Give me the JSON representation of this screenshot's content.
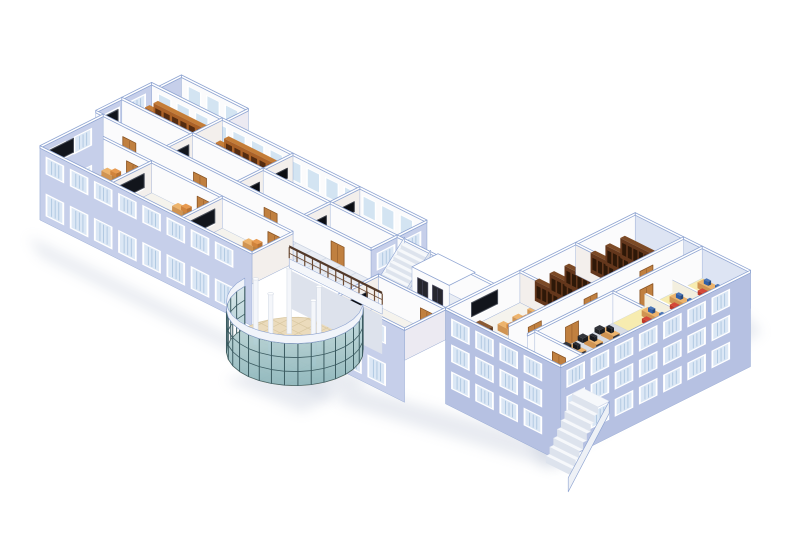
{
  "scene": {
    "canvas": {
      "w": 800,
      "h": 550,
      "background": "#ffffff"
    },
    "iso": {
      "ox": 40,
      "oy": 178,
      "kx": 1.86,
      "ky": 0.93,
      "wallH": 30
    },
    "palette": {
      "wallLavender": "#c6cfea",
      "wallLavenderDark": "#b6c1e2",
      "wallLavenderLight": "#dde4f3",
      "capFill": "#ffffff",
      "capLine": "#8da3d1",
      "interiorBright": "#fbfbfc",
      "interiorWarm": "#f3efec",
      "interiorShade": "#eceaf2",
      "floorRoom": "#f5f3ed",
      "floorCorr": "#e9edf4",
      "floorLab": "#d8dce4",
      "floorYellow": "#f0e9c4",
      "floorTerrace": "#eef1f7",
      "gridLine": "#ced6e3",
      "floorLobby": "#ebdbbc",
      "gridLobby": "#d9c8a2",
      "winFrame": "#ffffff",
      "winGlass": "#dbe7f5",
      "winStripe": "#adc6e0",
      "intWin": "#d3e4f2",
      "door": "#c08040",
      "doorDark": "#8a5424",
      "board": "#12151c",
      "boardFrame": "#4a4f5a",
      "tv": "#0b0d12",
      "deskTop": "#edb46d",
      "deskFront": "#d09452",
      "deskSide": "#ba8040",
      "chairTop": "#e79a50",
      "chairFront": "#d0833c",
      "chairSide": "#b87232",
      "tdeskTop": "#8a5a34",
      "tdeskFront": "#6e4223",
      "tdeskSide": "#59351b",
      "shelfTop": "#c57d37",
      "shelfFront": "#aa6127",
      "shelfSide": "#7e441c",
      "books": "#552c10",
      "shelfDTop": "#7c4a26",
      "shelfDFront": "#64371c",
      "shelfDSide": "#46230f",
      "booksD": "#2e1808",
      "monTop": "#2b2e36",
      "monFront": "#14161c",
      "monSide": "#1c1f26",
      "monBlueTop": "#4a76b8",
      "monBlueFront": "#2f5fa8",
      "monBlueSide": "#24487e",
      "chairBlackTop": "#33353b",
      "chairBlackFront": "#222428",
      "chairBlackSide": "#1a1c20",
      "chairRedTop": "#d4483a",
      "chairRedFront": "#c03828",
      "chairRedSide": "#992c20",
      "plant": "#2f9440",
      "plantDark": "#1f6b2d",
      "pot": "#8a5a34",
      "partTop": "#ffffff",
      "partFront": "#f3efdf",
      "partSide": "#e7e2cf",
      "stairTop": "#f6f8fb",
      "stairFront": "#dde3ed",
      "mat": "#f1e168",
      "lift": "#26262e",
      "liftFrame": "#4a4a5e",
      "rail": "#52392a",
      "railPost": "#6b4a33",
      "glassHi": "#d9e9ea",
      "glassLo": "#8cb7bf",
      "mullion": "#3b5b61",
      "fascia": "#f1f4fa",
      "colFill": "#f4f6fa",
      "colEdge": "#d8dee8",
      "underWall": "#dde2ec",
      "glowYellow": "#ffef9a",
      "shadow": "#b9c2d4"
    },
    "shadows": [
      {
        "pts": [
          [
            28,
            236
          ],
          [
            318,
            380
          ],
          [
            332,
            402
          ],
          [
            40,
            256
          ]
        ]
      },
      {
        "pts": [
          [
            225,
            380
          ],
          [
            302,
            412
          ],
          [
            372,
            380
          ],
          [
            300,
            358
          ]
        ]
      },
      {
        "pts": [
          [
            336,
            402
          ],
          [
            560,
            470
          ],
          [
            568,
            446
          ],
          [
            352,
            386
          ]
        ]
      },
      {
        "pts": [
          [
            544,
            468
          ],
          [
            762,
            332
          ],
          [
            744,
            312
          ],
          [
            530,
            446
          ]
        ]
      }
    ],
    "lobby": {
      "cu": 137,
      "cv": 0,
      "r": 26,
      "floorZ": -46,
      "glassTop": -4,
      "fasciaTop": 4,
      "arc": [
        182,
        408
      ],
      "arcStep": 11.3,
      "columns": [
        [
          123,
          -7
        ],
        [
          135,
          -11
        ],
        [
          150,
          -3
        ],
        [
          126,
          8
        ],
        [
          144,
          6
        ]
      ],
      "colTop": 20,
      "underWall": {
        "u0": 112,
        "u1": 162,
        "v": 22
      }
    },
    "railing": {
      "u0": 112,
      "u1": 162,
      "v": 22,
      "posts": 13
    },
    "layers": [
      {
        "t": "shadow",
        "id": "ground-shadow"
      },
      {
        "t": "floor",
        "id": "terrace-floor",
        "u0": 0,
        "v0": 64,
        "u1": 36,
        "v1": 76,
        "f": "terrace"
      },
      {
        "t": "wall",
        "id": "terrace-west-wall",
        "ax": "v",
        "c": 0,
        "a0": 64,
        "a1": 76,
        "f": "lav",
        "he": 10
      },
      {
        "t": "wall",
        "id": "terrace-north-wall",
        "ax": "u",
        "c": 76,
        "a0": 0,
        "a1": 36,
        "f": "intU",
        "strips": true
      },
      {
        "t": "wall",
        "id": "terrace-east-wall",
        "ax": "v",
        "c": 36,
        "a0": 64,
        "a1": 76,
        "f": "shade"
      },
      {
        "t": "floor",
        "id": "block-b-floor",
        "u0": -4,
        "v0": 34,
        "u1": 144,
        "v1": 64,
        "f": "room"
      },
      {
        "t": "wall",
        "id": "b-north-window-wall",
        "ax": "u",
        "c": 64,
        "a0": -4,
        "a1": 144,
        "f": "intU",
        "strips": true
      },
      {
        "t": "wall",
        "id": "b-west-cap",
        "ax": "v",
        "c": -4,
        "a0": 34,
        "a1": 64,
        "f": "lav",
        "he": 40,
        "win": {
          "rows": [
            [
              8,
              23
            ],
            [
              -32,
              -12
            ]
          ],
          "s": 4,
          "p": 14,
          "w": 8
        }
      },
      {
        "t": "room",
        "id": "library-1",
        "kind": "library",
        "u0": -4,
        "v0": 48,
        "u1": 34,
        "v1": 64
      },
      {
        "t": "wall",
        "id": "b-ncross-1",
        "ax": "v",
        "c": 34,
        "a0": 48,
        "a1": 64,
        "f": "intV"
      },
      {
        "t": "room",
        "id": "library-2",
        "kind": "library",
        "u0": 34,
        "v0": 48,
        "u1": 72,
        "v1": 64
      },
      {
        "t": "wall",
        "id": "b-ncross-2",
        "ax": "v",
        "c": 72,
        "a0": 48,
        "a1": 64,
        "f": "intV"
      },
      {
        "t": "room",
        "id": "media-office-1",
        "kind": "office",
        "u0": 72,
        "v0": 48,
        "u1": 108,
        "v1": 64
      },
      {
        "t": "wall",
        "id": "b-ncross-3",
        "ax": "v",
        "c": 108,
        "a0": 48,
        "a1": 64,
        "f": "intV"
      },
      {
        "t": "room",
        "id": "shelf-av-room",
        "kind": "libtv",
        "u0": 108,
        "v0": 48,
        "u1": 144,
        "v1": 64
      },
      {
        "t": "wall",
        "id": "b-mid-wall",
        "ax": "u",
        "c": 48,
        "a0": -4,
        "a1": 144,
        "f": "intU"
      },
      {
        "t": "room",
        "id": "classroom-b1",
        "kind": "classroomB",
        "u0": -4,
        "v0": 34,
        "u1": 34,
        "v1": 48
      },
      {
        "t": "wall",
        "id": "b-scross-1",
        "ax": "v",
        "c": 34,
        "a0": 34,
        "a1": 48,
        "f": "intV"
      },
      {
        "t": "room",
        "id": "classroom-b2",
        "kind": "classroomB",
        "u0": 34,
        "v0": 34,
        "u1": 72,
        "v1": 48
      },
      {
        "t": "wall",
        "id": "b-scross-2",
        "ax": "v",
        "c": 72,
        "a0": 34,
        "a1": 48,
        "f": "intV"
      },
      {
        "t": "room",
        "id": "media-office-2",
        "kind": "office",
        "u0": 72,
        "v0": 34,
        "u1": 108,
        "v1": 48
      },
      {
        "t": "wall",
        "id": "b-scross-3",
        "ax": "v",
        "c": 108,
        "a0": 34,
        "a1": 48,
        "f": "intV"
      },
      {
        "t": "room",
        "id": "media-office-3",
        "kind": "office",
        "u0": 108,
        "v0": 34,
        "u1": 144,
        "v1": 48
      },
      {
        "t": "wall",
        "id": "b-south-wall",
        "ax": "u",
        "c": 34,
        "a0": -4,
        "a1": 144,
        "f": "intU",
        "doors": [
          14,
          52,
          90,
          126
        ]
      },
      {
        "t": "wall",
        "id": "b-east-cap",
        "ax": "v",
        "c": 144,
        "a0": 34,
        "a1": 64,
        "f": "lav",
        "he": 40,
        "win": {
          "rows": [
            [
              8,
              23
            ],
            [
              -32,
              -12
            ]
          ],
          "s": 4,
          "p": 14,
          "w": 8
        }
      },
      {
        "t": "floor",
        "id": "main-corridor-floor",
        "u0": 0,
        "v0": 22,
        "u1": 196,
        "v1": 34,
        "f": "corr",
        "grid": {
          "du": 8,
          "dv": 4
        }
      },
      {
        "t": "floor",
        "id": "stairwell-floor",
        "u0": 144,
        "v0": 34,
        "u1": 196,
        "v1": 48,
        "f": "corr"
      },
      {
        "t": "wall",
        "id": "stairwell-back-wall",
        "ax": "u",
        "c": 48,
        "a0": 144,
        "a1": 196,
        "f": "intU"
      },
      {
        "t": "stairs",
        "id": "interior-staircase",
        "u0": 148,
        "u1": 162,
        "v0": 34,
        "v1": 48,
        "steps": 7,
        "rise": 4
      },
      {
        "t": "elevator",
        "id": "elevator-lobby",
        "u0": 166,
        "v0": 34,
        "u1": 186,
        "v1": 48,
        "h": 34
      },
      {
        "t": "floor",
        "id": "block-c-floor",
        "u0": 196,
        "v0": 22,
        "u1": 258,
        "v1": 124,
        "f": "room"
      },
      {
        "t": "wall",
        "id": "c-ne-cap",
        "ax": "u",
        "c": 124,
        "a0": 196,
        "a1": 258,
        "f": "lavL",
        "he": 6
      },
      {
        "t": "wall",
        "id": "c-nw-wall",
        "ax": "v",
        "c": 196,
        "a0": 22,
        "a1": 124,
        "f": "intU"
      },
      {
        "t": "room",
        "id": "classroom-c",
        "kind": "classroomC",
        "u0": 196,
        "v0": 30,
        "u1": 222,
        "v1": 62
      },
      {
        "t": "wall",
        "id": "c-cross-1",
        "ax": "u",
        "c": 62,
        "a0": 196,
        "a1": 222,
        "f": "intV"
      },
      {
        "t": "room",
        "id": "library-3",
        "kind": "libraryC",
        "u0": 196,
        "v0": 62,
        "u1": 222,
        "v1": 92
      },
      {
        "t": "wall",
        "id": "c-cross-2",
        "ax": "u",
        "c": 92,
        "a0": 196,
        "a1": 222,
        "f": "intV"
      },
      {
        "t": "room",
        "id": "library-4",
        "kind": "libraryC",
        "u0": 196,
        "v0": 92,
        "u1": 222,
        "v1": 124
      },
      {
        "t": "floor",
        "id": "c-corridor-floor",
        "u0": 222,
        "v0": 30,
        "u1": 232,
        "v1": 124,
        "f": "corr",
        "grid": {
          "du": 10,
          "dv": 6
        }
      },
      {
        "t": "wall",
        "id": "c-corridor-wall-1",
        "ax": "v",
        "c": 222,
        "a0": 30,
        "a1": 124,
        "f": "intU",
        "doors": [
          44,
          74,
          104
        ]
      },
      {
        "t": "wall",
        "id": "c-corridor-wall-2",
        "ax": "v",
        "c": 232,
        "a0": 30,
        "a1": 124,
        "f": "intU",
        "doors": [
          54,
          94
        ]
      },
      {
        "t": "floor",
        "id": "computer-lab-floor",
        "u0": 232,
        "v0": 34,
        "u1": 258,
        "v1": 76,
        "f": "lab"
      },
      {
        "t": "room",
        "id": "computer-lab",
        "kind": "lab",
        "u0": 232,
        "v0": 34,
        "u1": 258,
        "v1": 76
      },
      {
        "t": "wall",
        "id": "c-mid-wall",
        "ax": "u",
        "c": 76,
        "a0": 232,
        "a1": 258,
        "f": "intU"
      },
      {
        "t": "floor",
        "id": "office-suite-floor",
        "u0": 232,
        "v0": 76,
        "u1": 258,
        "v1": 124,
        "f": "yellow",
        "glow": true
      },
      {
        "t": "room",
        "id": "cubicle-office",
        "kind": "yellowOffice",
        "u0": 232,
        "v0": 76,
        "u1": 258,
        "v1": 124
      },
      {
        "t": "wall",
        "id": "lab-south-wall",
        "ax": "u",
        "c": 34,
        "a0": 232,
        "a1": 258,
        "f": "intU",
        "doors": [
          245
        ]
      },
      {
        "t": "wall",
        "id": "c-south-wall",
        "ax": "u",
        "c": 22,
        "a0": 196,
        "a1": 258,
        "f": "lavD",
        "he": 64,
        "win": {
          "rows": [
            [
              8,
              23
            ],
            [
              -18,
              -3
            ],
            [
              -45,
              -30
            ]
          ],
          "s": 4,
          "p": 13,
          "w": 8
        }
      },
      {
        "t": "wall",
        "id": "c-se-wall",
        "ax": "v",
        "c": 258,
        "a0": 22,
        "a1": 124,
        "f": "lavD",
        "he": 64,
        "win": {
          "rows": [
            [
              8,
              23
            ],
            [
              -18,
              -3
            ],
            [
              -45,
              -30
            ]
          ],
          "s": 4,
          "p": 13,
          "w": 8
        }
      },
      {
        "t": "extstairs",
        "id": "exterior-staircase",
        "u0": 258,
        "u1": 272,
        "vTop": 34,
        "steps": 7
      },
      {
        "t": "wall",
        "id": "a-corridor-wall-1",
        "ax": "u",
        "c": 22,
        "a0": 0,
        "a1": 114,
        "f": "intU",
        "doors": [
          28,
          66,
          104
        ]
      },
      {
        "t": "wall",
        "id": "a-corridor-wall-2",
        "ax": "u",
        "c": 22,
        "a0": 160,
        "a1": 196,
        "f": "intU",
        "doors": [
          186
        ]
      },
      {
        "t": "floor",
        "id": "block-a-floor",
        "u0": 0,
        "v0": 0,
        "u1": 114,
        "v1": 22,
        "f": "room"
      },
      {
        "t": "floor",
        "id": "a4-floor",
        "u0": 160,
        "v0": 0,
        "u1": 196,
        "v1": 22,
        "f": "room"
      },
      {
        "t": "wall",
        "id": "a-west-cap",
        "ax": "v",
        "c": 0,
        "a0": 0,
        "a1": 34,
        "f": "lav",
        "he": 42,
        "win": {
          "rows": [
            [
              8,
              23
            ],
            [
              -34,
              -14
            ]
          ],
          "s": 5,
          "p": 14,
          "w": 8
        }
      },
      {
        "t": "room",
        "id": "classroom-a1",
        "kind": "classroom",
        "u0": 0,
        "v0": 0,
        "u1": 38,
        "v1": 22
      },
      {
        "t": "wall",
        "id": "a-cross-1",
        "ax": "v",
        "c": 38,
        "a0": 0,
        "a1": 22,
        "f": "intV"
      },
      {
        "t": "room",
        "id": "classroom-a2",
        "kind": "classroom",
        "u0": 38,
        "v0": 0,
        "u1": 76,
        "v1": 22
      },
      {
        "t": "wall",
        "id": "a-cross-2",
        "ax": "v",
        "c": 76,
        "a0": 0,
        "a1": 22,
        "f": "intV"
      },
      {
        "t": "room",
        "id": "classroom-a3",
        "kind": "classroom",
        "u0": 76,
        "v0": 0,
        "u1": 114,
        "v1": 22
      },
      {
        "t": "wall",
        "id": "a-cross-3",
        "ax": "v",
        "c": 114,
        "a0": 0,
        "a1": 22,
        "f": "intV"
      },
      {
        "t": "wall",
        "id": "a-cross-4",
        "ax": "v",
        "c": 160,
        "a0": 0,
        "a1": 22,
        "f": "intV"
      },
      {
        "t": "room",
        "id": "reception-office",
        "kind": "office",
        "u0": 160,
        "v0": 0,
        "u1": 196,
        "v1": 22
      },
      {
        "t": "wall",
        "id": "a-east-cap",
        "ax": "v",
        "c": 196,
        "a0": 0,
        "a1": 22,
        "f": "shade"
      },
      {
        "t": "wall",
        "id": "a-south-wall-1",
        "ax": "u",
        "c": 0,
        "a0": 0,
        "a1": 114,
        "f": "lav",
        "he": 42,
        "win": {
          "rows": [
            [
              8,
              23
            ],
            [
              -34,
              -14
            ]
          ],
          "s": 4,
          "p": 13,
          "w": 8
        }
      },
      {
        "t": "wall",
        "id": "a-south-wall-2",
        "ax": "u",
        "c": 0,
        "a0": 160,
        "a1": 196,
        "f": "lav",
        "he": 42,
        "win": {
          "rows": [
            [
              8,
              23
            ],
            [
              -34,
              -14
            ]
          ],
          "s": 4,
          "p": 13,
          "w": 8
        }
      },
      {
        "t": "lobby",
        "id": "glass-atrium"
      },
      {
        "t": "railing",
        "id": "atrium-balcony-railing"
      }
    ]
  }
}
